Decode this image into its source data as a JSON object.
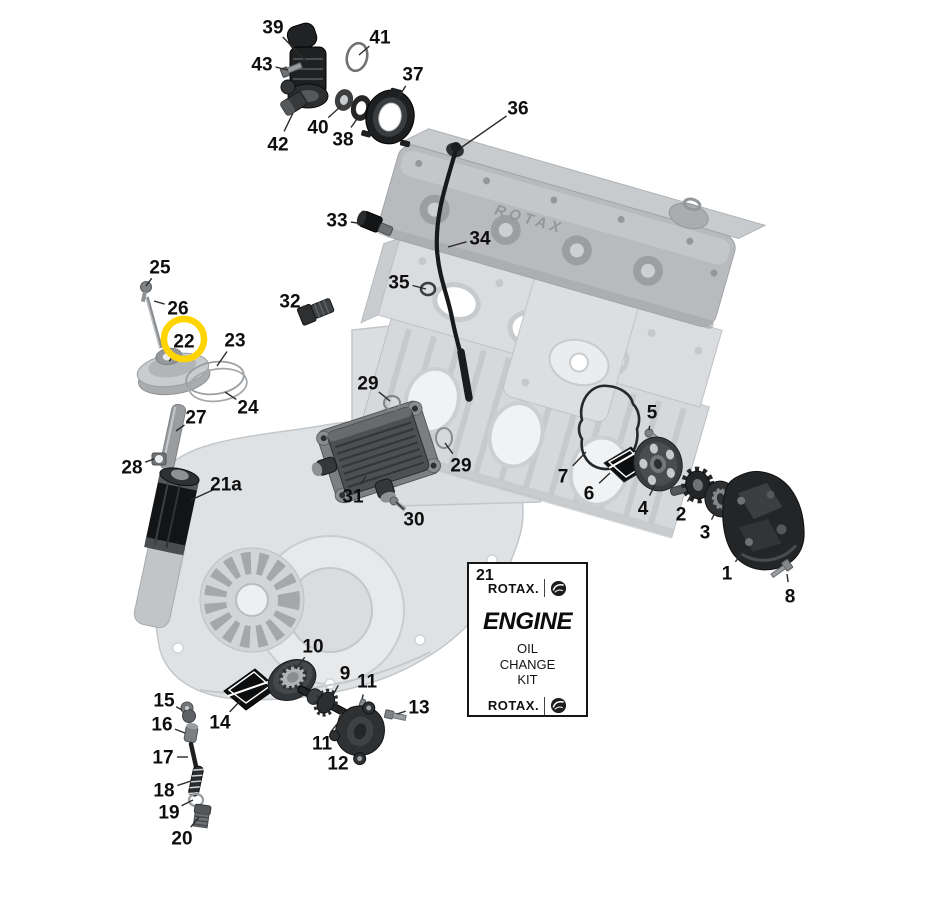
{
  "diagram": {
    "background": "#ffffff",
    "engine_brand_text": "ROTAX",
    "highlight": {
      "color": "#FFD400",
      "target_label": "22"
    },
    "callouts": [
      {
        "label": "39",
        "x": 273,
        "y": 27,
        "tx": 307,
        "ty": 62
      },
      {
        "label": "41",
        "x": 380,
        "y": 37,
        "tx": 359,
        "ty": 55
      },
      {
        "label": "43",
        "x": 262,
        "y": 64,
        "tx": 288,
        "ty": 70
      },
      {
        "label": "37",
        "x": 413,
        "y": 74,
        "tx": 397,
        "ty": 100
      },
      {
        "label": "36",
        "x": 518,
        "y": 108,
        "tx": 462,
        "ty": 147
      },
      {
        "label": "40",
        "x": 318,
        "y": 127,
        "tx": 341,
        "ty": 106
      },
      {
        "label": "38",
        "x": 343,
        "y": 139,
        "tx": 359,
        "ty": 116
      },
      {
        "label": "42",
        "x": 278,
        "y": 144,
        "tx": 293,
        "ty": 113
      },
      {
        "label": "33",
        "x": 337,
        "y": 220,
        "tx": 364,
        "ty": 224
      },
      {
        "label": "34",
        "x": 480,
        "y": 238,
        "tx": 448,
        "ty": 247
      },
      {
        "label": "25",
        "x": 160,
        "y": 267,
        "tx": 146,
        "ty": 286
      },
      {
        "label": "35",
        "x": 399,
        "y": 282,
        "tx": 426,
        "ty": 289
      },
      {
        "label": "26",
        "x": 178,
        "y": 308,
        "tx": 154,
        "ty": 301
      },
      {
        "label": "32",
        "x": 290,
        "y": 301,
        "tx": 313,
        "ty": 310
      },
      {
        "label": "22",
        "x": 184,
        "y": 341,
        "tx": 173,
        "ty": 356,
        "highlighted": true
      },
      {
        "label": "23",
        "x": 235,
        "y": 340,
        "tx": 217,
        "ty": 366
      },
      {
        "label": "24",
        "x": 248,
        "y": 407,
        "tx": 225,
        "ty": 392
      },
      {
        "label": "27",
        "x": 196,
        "y": 417,
        "tx": 176,
        "ty": 431
      },
      {
        "label": "29",
        "x": 368,
        "y": 383,
        "tx": 390,
        "ty": 401
      },
      {
        "label": "28",
        "x": 132,
        "y": 467,
        "tx": 154,
        "ty": 459
      },
      {
        "label": "29",
        "x": 461,
        "y": 465,
        "tx": 445,
        "ty": 443
      },
      {
        "label": "21a",
        "x": 226,
        "y": 484,
        "tx": 191,
        "ty": 500
      },
      {
        "label": "31",
        "x": 353,
        "y": 496,
        "tx": 366,
        "ty": 476
      },
      {
        "label": "30",
        "x": 414,
        "y": 519,
        "tx": 396,
        "ty": 502
      },
      {
        "label": "5",
        "x": 652,
        "y": 412,
        "tx": 649,
        "ty": 430
      },
      {
        "label": "7",
        "x": 563,
        "y": 476,
        "tx": 586,
        "ty": 452
      },
      {
        "label": "6",
        "x": 589,
        "y": 493,
        "tx": 610,
        "ty": 473
      },
      {
        "label": "4",
        "x": 643,
        "y": 508,
        "tx": 655,
        "ty": 485
      },
      {
        "label": "2",
        "x": 681,
        "y": 514,
        "tx": 691,
        "ty": 495
      },
      {
        "label": "3",
        "x": 705,
        "y": 532,
        "tx": 716,
        "ty": 511
      },
      {
        "label": "1",
        "x": 727,
        "y": 573,
        "tx": 745,
        "ty": 549
      },
      {
        "label": "8",
        "x": 790,
        "y": 596,
        "tx": 787,
        "ty": 574
      },
      {
        "label": "10",
        "x": 313,
        "y": 646,
        "tx": 296,
        "ty": 669
      },
      {
        "label": "9",
        "x": 345,
        "y": 673,
        "tx": 333,
        "ty": 695
      },
      {
        "label": "11",
        "x": 367,
        "y": 681,
        "tx": 362,
        "ty": 699
      },
      {
        "label": "15",
        "x": 164,
        "y": 700,
        "tx": 182,
        "ty": 710
      },
      {
        "label": "13",
        "x": 419,
        "y": 707,
        "tx": 397,
        "ty": 714
      },
      {
        "label": "14",
        "x": 220,
        "y": 722,
        "tx": 241,
        "ty": 700
      },
      {
        "label": "16",
        "x": 162,
        "y": 724,
        "tx": 185,
        "ty": 733
      },
      {
        "label": "11",
        "x": 322,
        "y": 743,
        "tx": 341,
        "ty": 719
      },
      {
        "label": "17",
        "x": 163,
        "y": 757,
        "tx": 188,
        "ty": 757
      },
      {
        "label": "12",
        "x": 338,
        "y": 763,
        "tx": 357,
        "ty": 745
      },
      {
        "label": "18",
        "x": 164,
        "y": 790,
        "tx": 191,
        "ty": 781
      },
      {
        "label": "19",
        "x": 169,
        "y": 812,
        "tx": 193,
        "ty": 800
      },
      {
        "label": "20",
        "x": 182,
        "y": 838,
        "tx": 199,
        "ty": 817
      }
    ]
  },
  "kit_box": {
    "number": "21",
    "brand_top": "ROTAX.",
    "title": "ENGINE",
    "lines": [
      "OIL",
      "CHANGE",
      "KIT"
    ],
    "brand_bottom": "ROTAX."
  }
}
